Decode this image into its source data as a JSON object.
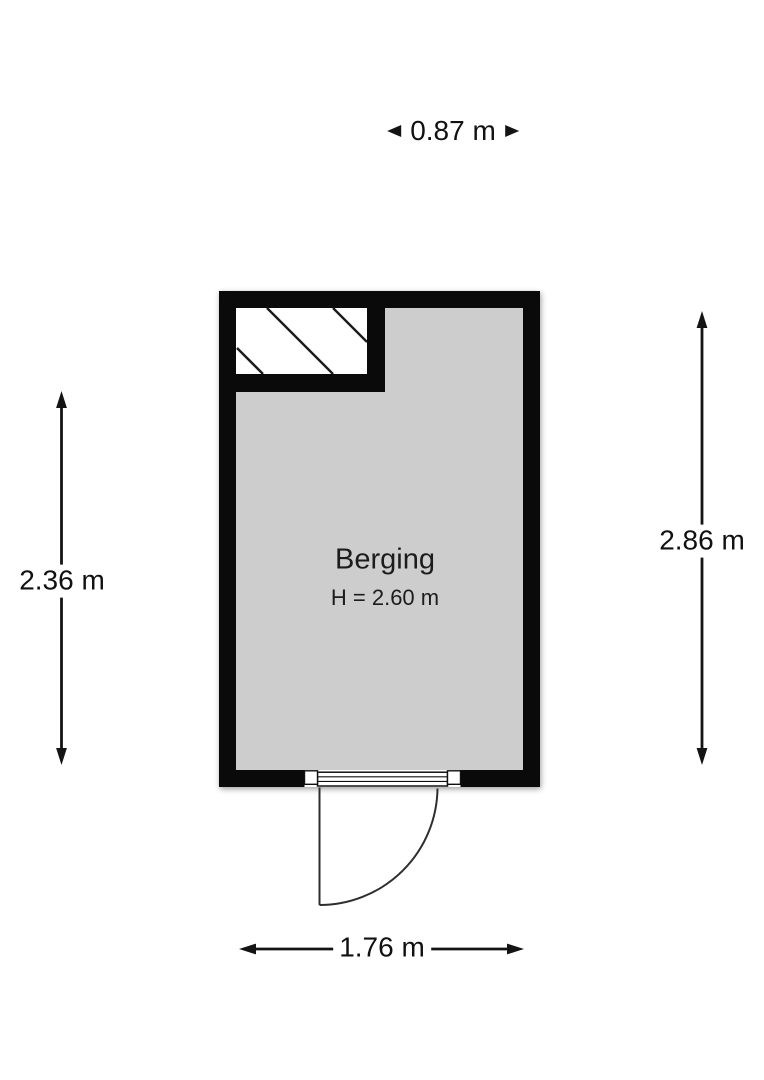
{
  "floorplan": {
    "room": {
      "name": "Berging",
      "ceiling_height": "H = 2.60 m"
    },
    "dimensions": {
      "top_width": "0.87 m",
      "left_height": "2.36 m",
      "right_height": "2.86 m",
      "bottom_width": "1.76 m"
    },
    "colors": {
      "wall": "#0a0a0a",
      "floor": "#cdcdcd",
      "hatch": "#1a1a1a",
      "door_line": "#2e2e2e",
      "dimension": "#141414"
    }
  }
}
